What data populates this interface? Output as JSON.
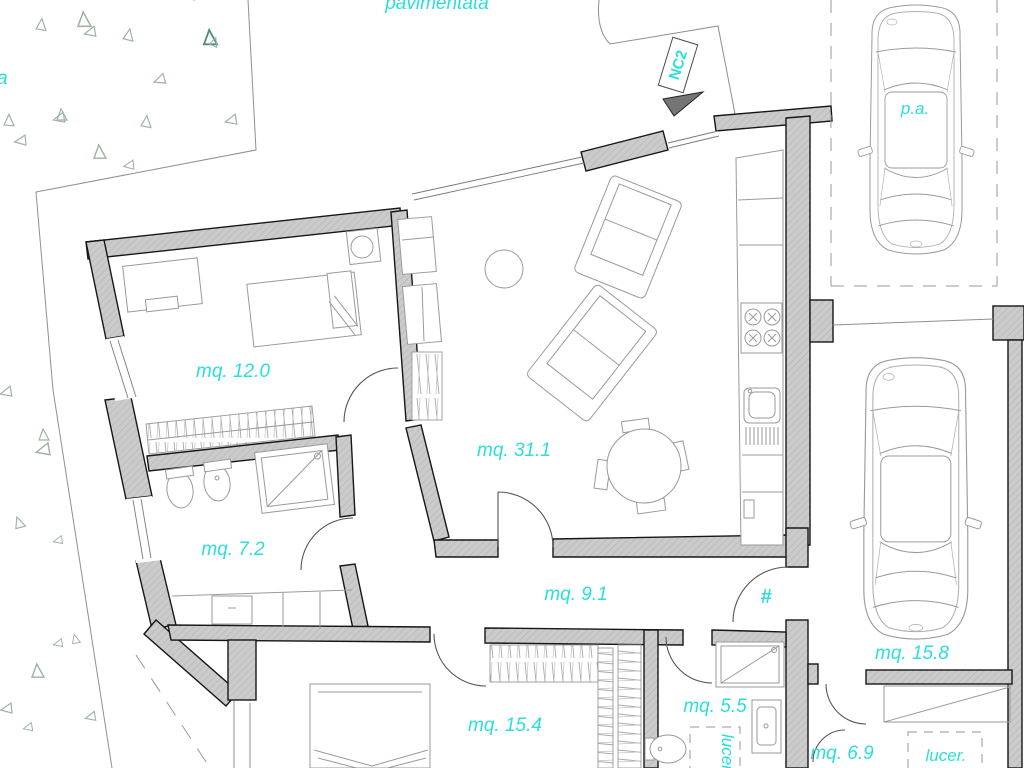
{
  "plan": {
    "site_labels": {
      "paved_area": "pavimentata",
      "edge_letter": "a",
      "entrance_code": "NC2",
      "parking_space": "p.a."
    },
    "rooms": {
      "bedroom1_area": "mq. 12.0",
      "living_area": "mq. 31.1",
      "bathroom1_area": "mq. 7.2",
      "hallway_area": "mq. 9.1",
      "bedroom2_area": "mq. 15.4",
      "bathroom2_area": "mq. 5.5",
      "garage_area": "mq. 15.8",
      "storage_area": "mq. 6.9"
    },
    "annotations": {
      "hash_mark": "#",
      "skylight_vertical": "lucer.",
      "skylight_right": "lucer."
    },
    "colors": {
      "label_cyan": "#2BDFD8",
      "wall_fill": "#C9C9C9",
      "wall_stroke": "#161616",
      "thin_line": "#8f8f8f",
      "furniture_line": "#9a9a9a",
      "vegetation": "#9fb3a6",
      "vegetation_dark": "#4e8e78",
      "arrow_fill": "#757575"
    }
  }
}
